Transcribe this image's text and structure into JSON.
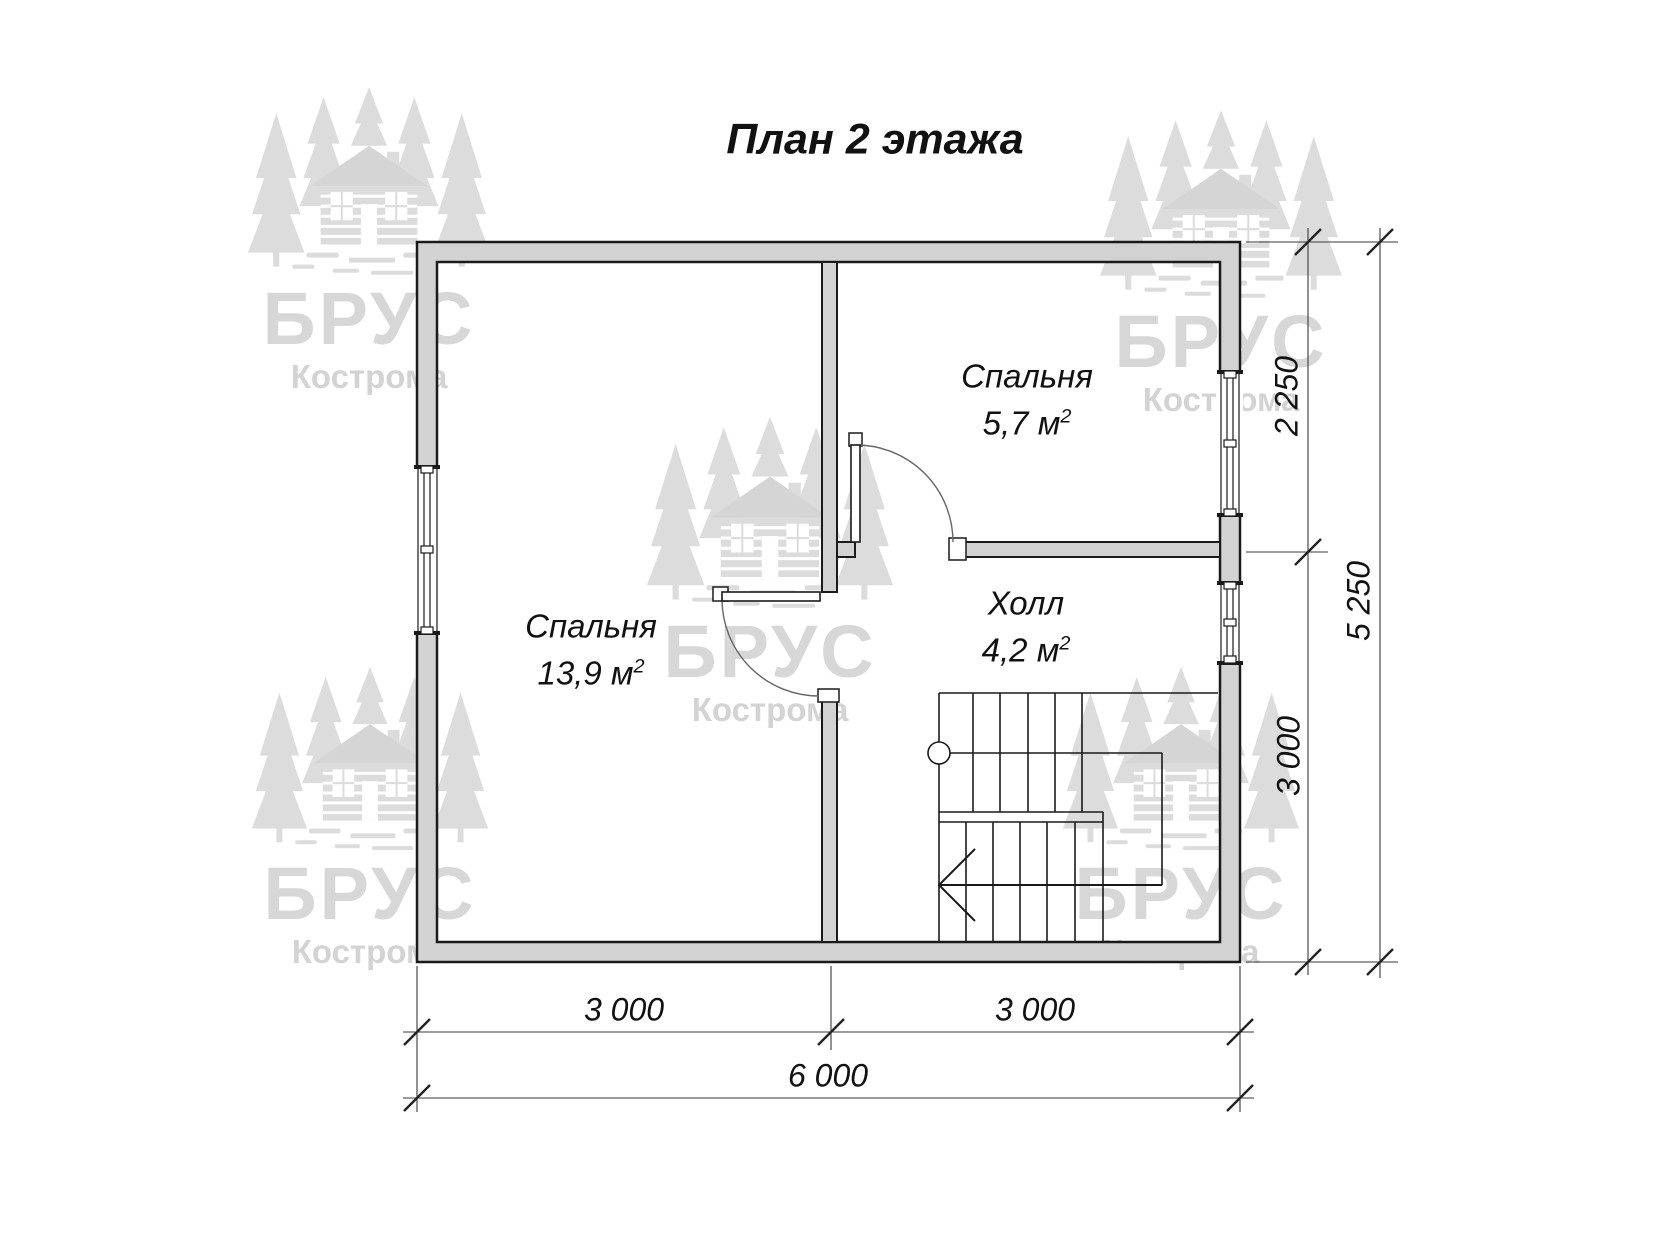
{
  "title": "План 2 этажа",
  "rooms": {
    "bedroom_small": {
      "name": "Спальня",
      "area": "5,7 м",
      "area_sup": "2"
    },
    "bedroom_large": {
      "name": "Спальня",
      "area": "13,9 м",
      "area_sup": "2"
    },
    "hall": {
      "name": "Холл",
      "area": "4,2 м",
      "area_sup": "2"
    }
  },
  "dimensions": {
    "right_inner_top": "2 250",
    "right_inner_bottom": "3 000",
    "right_outer": "5 250",
    "bottom_left": "3 000",
    "bottom_right": "3 000",
    "bottom_total": "6 000"
  },
  "watermark": {
    "brand": "БРУС",
    "city": "Кострома"
  },
  "colors": {
    "wall_fill": "#d2d2d2",
    "wall_line": "#1a1a1a",
    "dim_line": "#3a3a3a",
    "watermark_gray": "#dcdcdc"
  }
}
